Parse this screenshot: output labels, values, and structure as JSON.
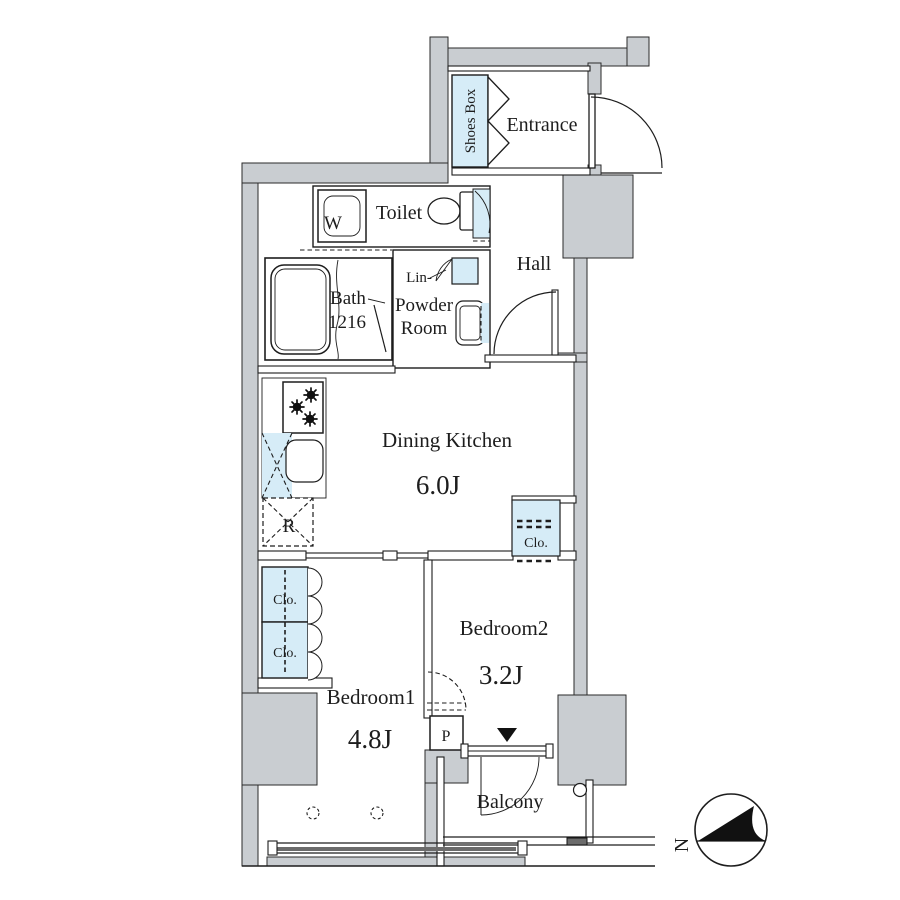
{
  "colors": {
    "wall": "#c9cdd1",
    "fixture_blue": "#d6ecf7",
    "line": "#1d1d1d",
    "rail_dark": "#6b6b6b"
  },
  "rooms": {
    "entrance": {
      "name": "Entrance"
    },
    "hall": {
      "name": "Hall"
    },
    "toilet": {
      "name": "Toilet"
    },
    "bath": {
      "name": "Bath",
      "size": "1216"
    },
    "powder_room": {
      "line1": "Powder",
      "line2": "Room"
    },
    "dining_kitchen": {
      "name": "Dining Kitchen",
      "area": "6.0J"
    },
    "bedroom1": {
      "name": "Bedroom1",
      "area": "4.8J"
    },
    "bedroom2": {
      "name": "Bedroom2",
      "area": "3.2J"
    },
    "balcony": {
      "name": "Balcony"
    }
  },
  "labels": {
    "shoes_box": "Shoes Box",
    "washing_machine": "W",
    "linen": "Lin-",
    "refrigerator": "R",
    "pipe_space": "P",
    "compass_north": "N",
    "closets": [
      "Clo.",
      "Clo.",
      "Clo."
    ]
  }
}
